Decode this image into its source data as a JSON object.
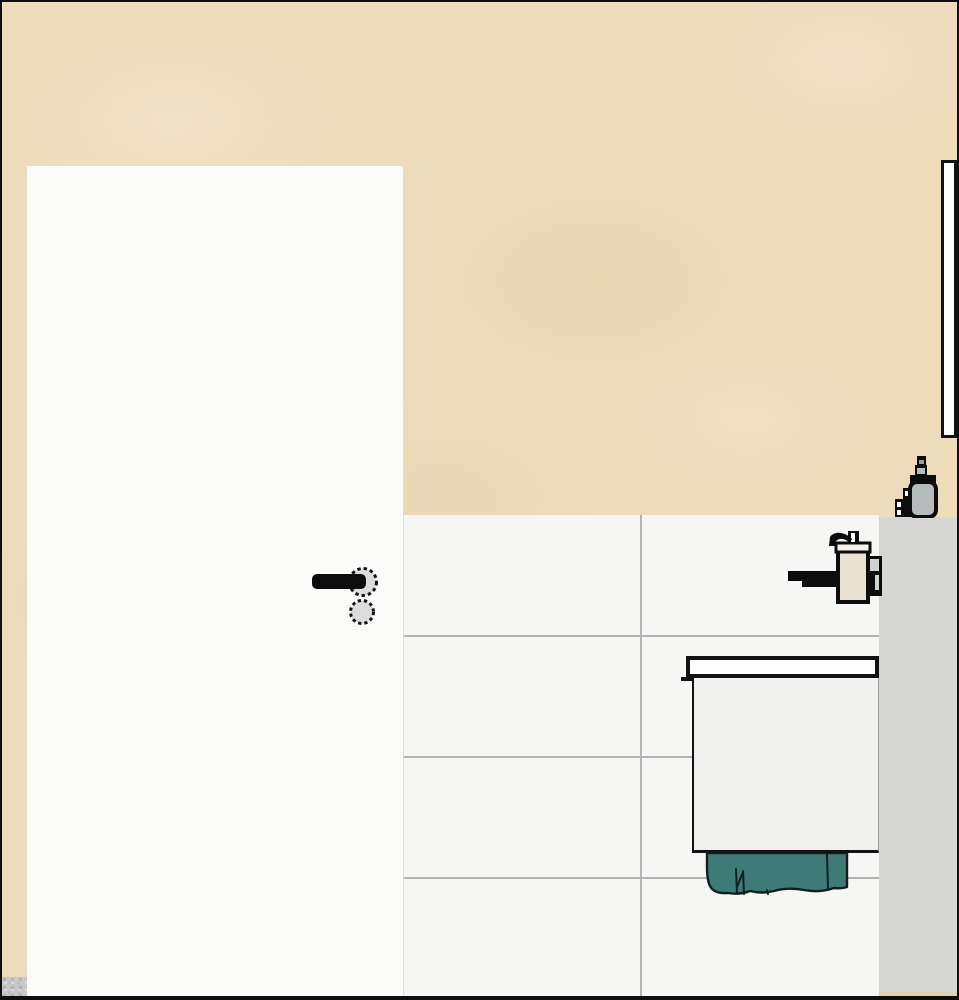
{
  "app": {
    "view_label": "bathroom-elevation-view",
    "description": "2D side elevation of a bathroom wall: beige plaster wall, white door with lever handle, white tiled lower wall, gray partition wall section, wall mirror seen edge-on, wall-mounted soap dispenser with holder, toiletry bottles on the partition ledge, vanity unit with countertop and a teal towel hanging below"
  },
  "colors": {
    "border_black": "#0f0f0f",
    "outline_black": "#121212",
    "metal_black": "#0c0c0c",
    "wall_beige": "#eddcbc",
    "door_white": "#fbfbfa",
    "tile_white": "#f6f6f5",
    "grout_gray": "#b3b3b3",
    "partition_gray": "#d6d7d5",
    "floor_gray": "#c8c8c8",
    "floor_tan": "#e3cfa7",
    "mirror_white": "#fdfdfd",
    "rosette_gray": "#dcdcdc",
    "bottle_beige": "#e9e2d4",
    "bottle_gray": "#b5bcbc",
    "bracket_gray": "#cfd3d1",
    "collar_white": "#f5f2ea",
    "counter_white": "#fdfdfd",
    "cabinet_white": "#f0f1ef",
    "towel_teal": "#3f7b76",
    "towel_line": "#10201e"
  },
  "objects": {
    "beige_wall": {
      "label": "plaster wall"
    },
    "door": {
      "label": "door panel"
    },
    "door_handle": {
      "label": "door lever handle with rosette and escutcheon"
    },
    "tiled_wall": {
      "label": "tiled wall",
      "tile_columns": 2,
      "tile_rows": 4
    },
    "partition": {
      "label": "partition wall section"
    },
    "floor_cut": {
      "label": "floor section cut"
    },
    "mirror": {
      "label": "mirror edge view"
    },
    "bottles": {
      "label": "toiletry bottles on ledge"
    },
    "dispenser": {
      "label": "wall-mounted soap dispenser with holder"
    },
    "counter": {
      "label": "vanity countertop"
    },
    "cabinet": {
      "label": "vanity cabinet"
    },
    "towel": {
      "label": "hanging towel"
    }
  }
}
